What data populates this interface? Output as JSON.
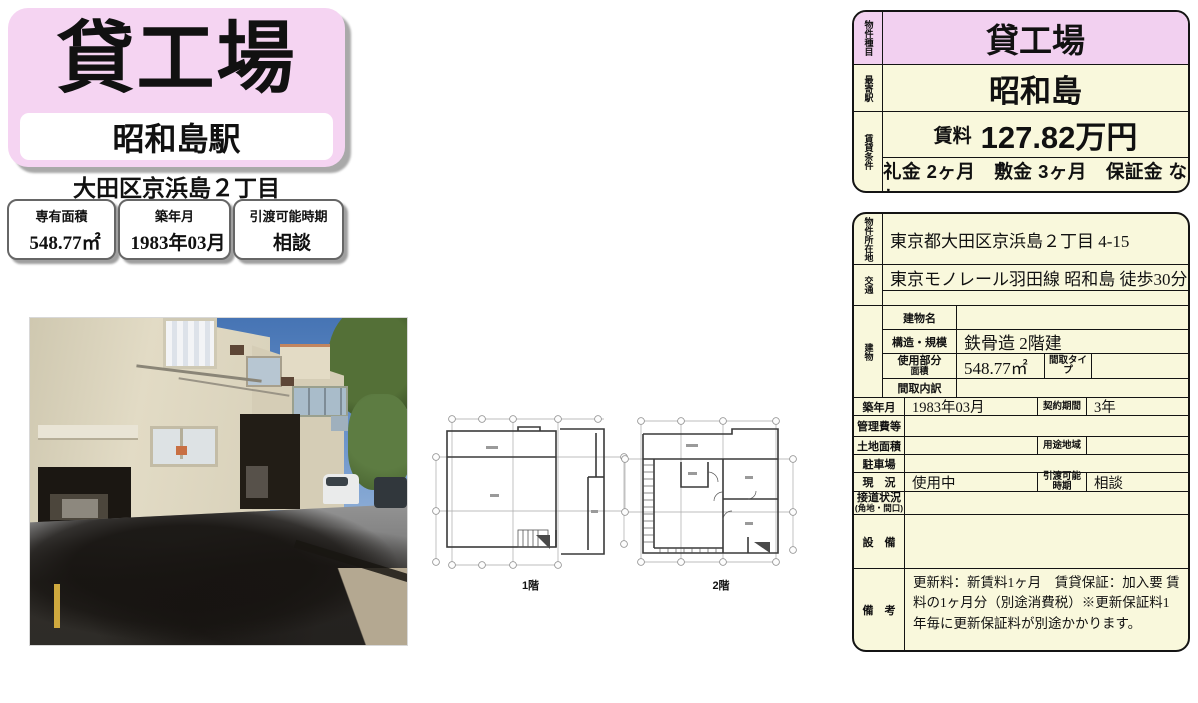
{
  "flyer": {
    "title": "貸工場",
    "station": "昭和島駅",
    "address": "大田区京浜島２丁目",
    "specs": [
      {
        "label": "専有面積",
        "value": "548.77㎡"
      },
      {
        "label": "築年月",
        "value": "1983年03月"
      },
      {
        "label": "引渡可能時期",
        "value": "相談"
      }
    ]
  },
  "floorplans": [
    {
      "caption": "1階"
    },
    {
      "caption": "2階"
    }
  ],
  "summary": {
    "property_type_label": "物件種目",
    "property_type": "貸工場",
    "station_label": "最寄駅",
    "station": "昭和島",
    "terms_label": "賃貸条件",
    "rent_label": "賃料",
    "rent_value": "127.82万円",
    "terms": "礼金 2ヶ月　敷金 3ヶ月　保証金 なし"
  },
  "detail": {
    "location": {
      "label": "物件所在地",
      "value": "東京都大田区京浜島２丁目 4-15"
    },
    "access": {
      "label": "交通",
      "line1": "東京モノレール羽田線 昭和島 徒歩30分",
      "line2": ""
    },
    "building": {
      "label": "建物",
      "name": {
        "label": "建物名",
        "value": ""
      },
      "structure": {
        "label": "構造・規模",
        "value": "鉄骨造 2階建"
      },
      "area": {
        "label1": "使用部分",
        "label2": "面積",
        "value": "548.77㎡",
        "type_label": "間取タイプ",
        "type_value": ""
      },
      "layout": {
        "label": "間取内訳",
        "value": ""
      }
    },
    "built": {
      "label": "築年月",
      "value": "1983年03月",
      "term_label": "契約期間",
      "term_value": "3年"
    },
    "fees": {
      "label": "管理費等",
      "value": ""
    },
    "land": {
      "label": "土地面積",
      "value": "",
      "zone_label": "用途地域",
      "zone_value": ""
    },
    "parking": {
      "label": "駐車場",
      "value": ""
    },
    "status": {
      "label": "現　況",
      "value": "使用中",
      "handover_label": "引渡可能時期",
      "handover_value": "相談"
    },
    "road": {
      "label": "接道状況",
      "sublabel": "(角地・間口)",
      "value": ""
    },
    "equipment": {
      "label": "設　備",
      "value": ""
    },
    "notes": {
      "label": "備　考",
      "value": "更新料：新賃料1ヶ月　賃貸保証：加入要 賃料の1ヶ月分（別途消費税）※更新保証料1年毎に更新保証料が別途かかります。"
    }
  },
  "colors": {
    "pink": "#f5d4f2",
    "table_pink": "#f2d0f0",
    "cream": "#f9f8dc",
    "border": "#141414"
  }
}
